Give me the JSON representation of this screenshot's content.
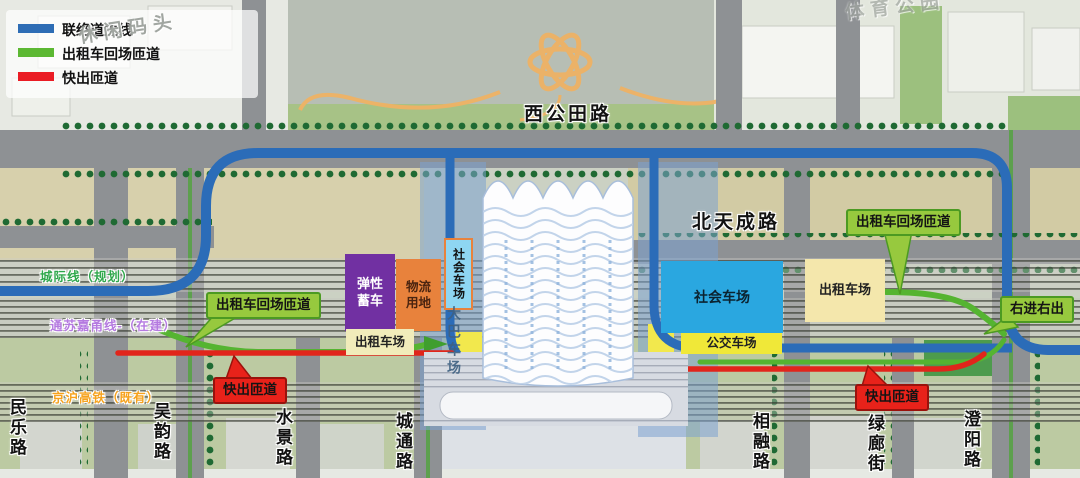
{
  "legend": {
    "items": [
      {
        "label": "联络道主线",
        "color": "#2e6db5"
      },
      {
        "label": "出租车回场匝道",
        "color": "#5cb832"
      },
      {
        "label": "快出匝道",
        "color": "#ea1c24"
      }
    ]
  },
  "watermarks": {
    "pier": "休闲码头",
    "sports": "体育公园"
  },
  "roads": {
    "xigongtian": "西公田路",
    "beitiancheng": "北天成路",
    "vertical": [
      "民乐路",
      "吴韵路",
      "水景路",
      "城通路",
      "相融路",
      "绿廊街",
      "澄阳路"
    ]
  },
  "railways": {
    "planned": {
      "label": "城际线（规划）",
      "color": "#2fa84c"
    },
    "under_construction": {
      "label": "通苏嘉甬线-（在建）",
      "color": "#b57ae0"
    },
    "existing": {
      "label": "京沪高铁（既有）",
      "color": "#f6a21d"
    }
  },
  "badges": {
    "taxi_return_left": "出租车回场匝道",
    "taxi_return_right": "出租车回场匝道",
    "right_in_right_out": "右进右出",
    "fast_exit_left": "快出匝道",
    "fast_exit_right": "快出匝道"
  },
  "parking": {
    "flex_storage": "弹性蓄车",
    "logistics": "物流用地",
    "taxi_left": "出租车场",
    "social_small": "社会车场",
    "bus_coach": "大巴车场",
    "social_main": "社会车场",
    "transit_bus": "公交车场",
    "taxi_right": "出租车场"
  }
}
